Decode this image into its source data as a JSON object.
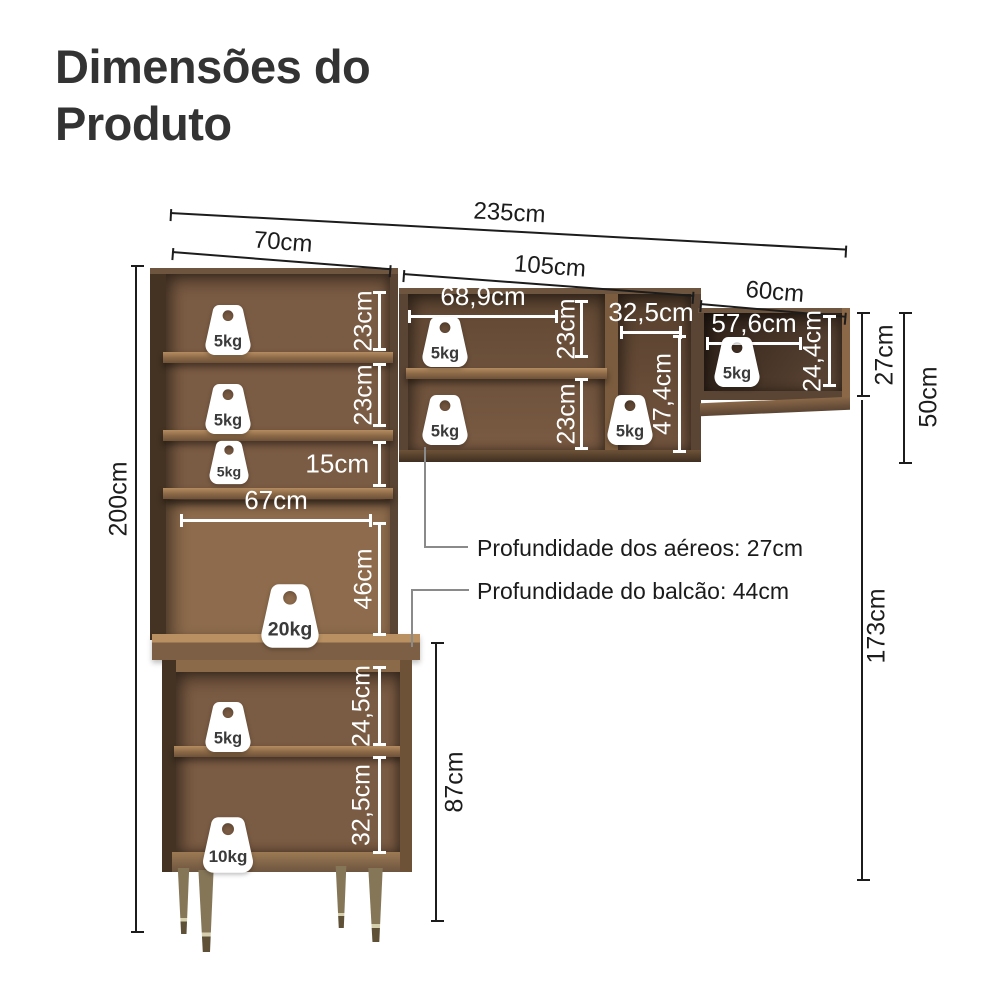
{
  "title": {
    "line1": "Dimensões do",
    "line2": "Produto"
  },
  "dims": {
    "total_width": "235cm",
    "left_width": "70cm",
    "mid_width": "105cm",
    "right_width": "60cm",
    "left_height": "200cm",
    "hutch_shelf1": "23cm",
    "hutch_shelf2": "23cm",
    "hutch_shelf3": "15cm",
    "hutch_inner_width": "67cm",
    "hutch_open_height": "46cm",
    "base_shelf1": "24,5cm",
    "base_shelf2": "32,5cm",
    "base_height": "87cm",
    "mid_inner_width": "68,9cm",
    "mid_shelf1": "23cm",
    "mid_shelf2": "23cm",
    "mid_right_width": "32,5cm",
    "mid_right_height": "47,4cm",
    "right_inner_width": "57,6cm",
    "right_inner_height": "24,4cm",
    "right_cab_height": "27cm",
    "right_gap": "50cm",
    "right_column_height": "173cm"
  },
  "notes": {
    "aereos": "Profundidade dos aéreos: 27cm",
    "balcao": "Profundidade do balcão: 44cm"
  },
  "weights": {
    "hutch1": "5kg",
    "hutch2": "5kg",
    "hutch3": "5kg",
    "hutch_open": "20kg",
    "base1": "5kg",
    "base2": "10kg",
    "mid1": "5kg",
    "mid2": "5kg",
    "mid_right": "5kg",
    "right": "5kg"
  },
  "colors": {
    "wood_frame": "#5a4433",
    "wood_interior": "#7a5b43",
    "wood_light_edge": "#b08a60",
    "dim_line": "#1c1c1c",
    "white_dim": "#ffffff",
    "leader_gray": "#8a8a8a",
    "leg": "#7d6f52",
    "title_text": "#333333"
  }
}
